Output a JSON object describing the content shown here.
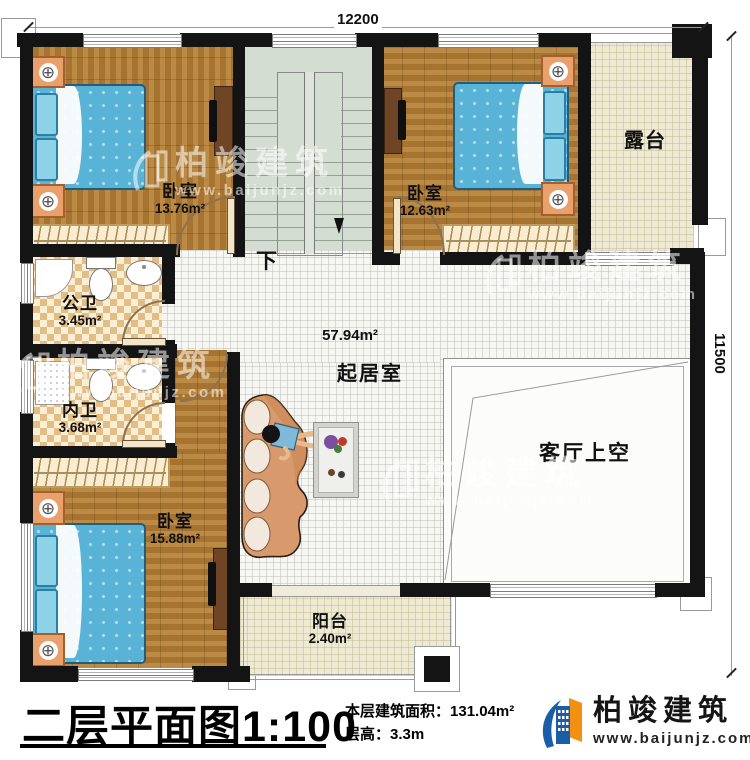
{
  "dimensions": {
    "top": "12200",
    "right": "11500"
  },
  "rooms": {
    "bedroom_top_left": {
      "name": "卧室",
      "area": "13.76m²"
    },
    "bedroom_top_right": {
      "name": "卧室",
      "area": "12.63m²"
    },
    "terrace": {
      "name": "露台"
    },
    "public_bathroom": {
      "name": "公卫",
      "area": "3.45m²"
    },
    "private_bathroom": {
      "name": "内卫",
      "area": "3.68m²"
    },
    "bedroom_bottom": {
      "name": "卧室",
      "area": "15.88m²"
    },
    "living_room": {
      "name": "起居室",
      "area": "57.94m²"
    },
    "living_void": {
      "name": "客厅上空"
    },
    "balcony": {
      "name": "阳台",
      "area": "2.40m²"
    }
  },
  "stairs": {
    "down_label": "下"
  },
  "icons": {
    "lamp": "⊕"
  },
  "titlebar": {
    "plan_title": "二层平面图",
    "plan_scale": "1:100",
    "area_label": "本层建筑面积：",
    "area_value": "131.04m²",
    "floor_height_label": "层高：",
    "floor_height_value": "3.3m"
  },
  "brand": {
    "name": "柏竣建筑",
    "website": "www.baijunjz.com"
  },
  "watermark": {
    "name": "柏竣建筑",
    "website": "www.baijunjz.com"
  },
  "colors": {
    "wall": "#141414",
    "wood": "#b07c35",
    "bed": "#58b3d6",
    "tile_beige": "#ede9d3",
    "stair": "#d4ddd2",
    "brand_blue": "#1b5ea7",
    "brand_orange": "#f29111"
  }
}
